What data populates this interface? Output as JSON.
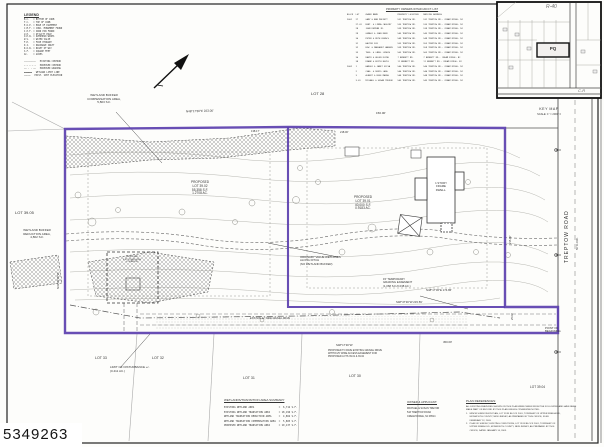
{
  "stamp": "5349263",
  "legend": {
    "title": "LEGEND",
    "entries": [
      "B.C.   = BOTTOM OF CURB",
      "T.C.   = TOP OF CURB",
      "E.O.P. = EDGE OF PAVEMENT",
      "C.M.F. = CONC. MONUMENT FOUND",
      "I.P.F. = IRON PIN FOUND",
      "U.P.   = UTILITY POLE",
      "O.H.W. = OVERHEAD WIRES",
      "W.V.   = WATER VALVE",
      "F.H.   = FIRE HYDRANT",
      "D.I.   = DRAINAGE INLET",
      "R.O.W. = RIGHT OF WAY",
      "S.F.   = SQUARE FEET",
      "AC.    = ACRES"
    ],
    "linetypes": [
      "─────────   EXISTING CONTOUR",
      "─ ─ ─ ─ ─   PROPOSED CONTOUR",
      "── · · ──   PROPOSED GRADING",
      "▬▬▬▬▬▬   WETLAND LIMIT LINE",
      "⋯⋯⋯⋯⋯   EXIST. SPOT ELEVATION"
    ]
  },
  "owners_table": {
    "title": "PROPERTY OWNERS WITHIN 200 FT. LIST",
    "header": "BLOCK  LOT     OWNER NAME                PROPERTY LOCATION    MAILING ADDRESS",
    "rows": [
      "2001   27      GARY & ANN MOFFETT        531 TREPTOW RD.      531 TREPTOW RD., CREAM RIDGE, NJ",
      "       27.01   ROBT. & LINDA CASSIDY     535 TREPTOW RD.      535 TREPTOW RD., CREAM RIDGE, NJ",
      "       28      JOHN DEMYAN JR.           539 TREPTOW RD.      539 TREPTOW RD., CREAM RIDGE, NJ",
      "       29      GERALD & JOAN REED        545 TREPTOW RD.      545 TREPTOW RD., CREAM RIDGE, NJ",
      "       30      PETER & RUTH KOVACS       549 TREPTOW RD.      549 TREPTOW RD., CREAM RIDGE, NJ",
      "       31      WALTER FOX                553 TREPTOW RD.      553 TREPTOW RD., CREAM RIDGE, NJ",
      "       32      EDW. & MARGARET HANSEN    559 TREPTOW RD.      559 TREPTOW RD., CREAM RIDGE, NJ",
      "       33      THOS. & CAROL LUDWIG      563 TREPTOW RD.      563 TREPTOW RD., CREAM RIDGE, NJ",
      "       36      DAVID & HELEN KLINE       7 BENNETT RD.        7 BENNETT RD., CREAM RIDGE, NJ",
      "       38      FRANK & EDITH BOYLE       11 BENNETT RD.       11 BENNETT RD., CREAM RIDGE, NJ",
      "2002   1       HAROLD & JANET SILVA      540 TREPTOW RD.      540 TREPTOW RD., CREAM RIDGE, NJ",
      "       2       CHAS. & DORIS LANG        544 TREPTOW RD.      544 TREPTOW RD., CREAM RIDGE, NJ",
      "       3       ALBERT & ROSE MARSH       548 TREPTOW RD.      548 TREPTOW RD., CREAM RIDGE, NJ",
      "       3.01    MICHAEL & SUSAN TREVOR    543 TREPTOW RD.      543 TREPTOW RD., CREAM RIDGE, NJ"
    ]
  },
  "key_map": {
    "label": "KEY MAP",
    "scale": "SCALE: 1\" = 2000' ±",
    "zone_r40": "R-40",
    "zone_cr": "C-R",
    "parcel": "PQ"
  },
  "labels": {
    "wetland_comp": "WETLAND BUFFER\nCOMPENSATION AREA,\n5,803 S.F.",
    "lot28": "LOT 28",
    "lot3905": "LOT 39.05",
    "wetland_red": "WETLAND BUFFER\nREDUCTION AREA,\n4,862 S.F.",
    "prop3902": "PROPOSED\nLOT 39.02\n55,358 S.F.\n1.2708 AC.",
    "prop3901": "PROPOSED\nLOT 39.01\n40,000 S.F.\n0.9183 AC.",
    "dwell1story": "1 STORY\nFRAME\nDWELL.",
    "prop_dwelling": "PROPOSED\n2 STY DWELLING\nLOCATION",
    "ordinary_wetlands": "ORDINARY VALUE WETLANDS\nALONG DITCH\n(NO WETLAND BUFFER)",
    "grading_easement": "15' TEMPORARY\nGRADING EASEMENT\n(1,068 S.F./0.038 AC.)",
    "existing_drive": "EXISTING 12' WIDE GRAVEL DRIVE",
    "pave_note": "PROPOSED TO PAVE EXISTING GRAVEL DRIVE\nWITHIN 25' WIDE ACCESS EASEMENT FOR\nPROPOSED LOTS 39.01 & 39.02",
    "limit_disturbance": "LIMIT OF DISTURBANCE +/-\n(0.411 AC.)",
    "lot33": "LOT 33",
    "lot32": "LOT 32",
    "lot31": "LOT 31",
    "lot30": "LOT 30",
    "lot3904": "LOT 39.04",
    "point_of_beginning": "POINT OF\nBEGINNING",
    "treptow_road": "TREPTOW ROAD",
    "row50": "50' R.O.W."
  },
  "bearings": {
    "top": "N48°17'30\"E   223.00'",
    "d150": "150.00'",
    "d138": "138.17'",
    "d218": "218.00'",
    "n4817": "N48°17'30\"E   174.86'",
    "s4847": "S48°47'30\"W   215.59'",
    "s4817": "S48°17'30\"W",
    "d450": "450.00'",
    "d25": "25.00'",
    "d215": "215.00'",
    "n4142": "N41°42'30\"W"
  },
  "summary_table": {
    "title": "WETLANDS/TRANSITION AREA SUMMARY",
    "rows": [
      "EXISTING WETLAND AREA                 =  6,712 S.F.",
      "EXISTING WETLAND TRANSITION AREA      = 18,196 S.F.",
      "WETLAND TRANSITION REDUCTION AREA     =  4,862 S.F.",
      "WETLAND TRANSITION COMPENSATION AREA  =  5,803 S.F.",
      "PROPOSED WETLAND TRANSITION AREA      = 19,137 S.F."
    ]
  },
  "owner_block": {
    "title": "OWNER & APPLICANT:",
    "lines": [
      "MICHAEL & SUSAN TREVOR",
      "543 TREPTOW ROAD",
      "CREAM RIDGE, NJ 08514"
    ]
  },
  "plan_refs": {
    "title": "PLAN REFERENCES:",
    "lines": [
      "ALL EXISTING FEATURES SHOWN ON THIS PLAN WERE TAKEN FROM THE FOLLOWING AND HAVE BEEN",
      "MADE PART OF RECORD BY THIS PLAN UNLESS OTHERWISE NOTED:",
      "1.   MINOR SUBDIVISION PLAN, LOT 39 IN BLOCK 2001, TOWNSHIP OF UPPER FREEHOLD,",
      "      MONMOUTH COUNTY, NEW JERSEY, AS PREPARED BY THIS OFFICE, FILED",
      "      FEBRUARY 12, 2003.",
      "2.   PLAN OF SURVEY, EXISTING CONDITIONS, LOT 39 IN BLOCK 2001, TOWNSHIP OF",
      "      UPPER FREEHOLD, MONMOUTH COUNTY, NEW JERSEY, AS PREPARED BY THIS",
      "      OFFICE, DATED JANUARY 14, 2003."
    ]
  }
}
